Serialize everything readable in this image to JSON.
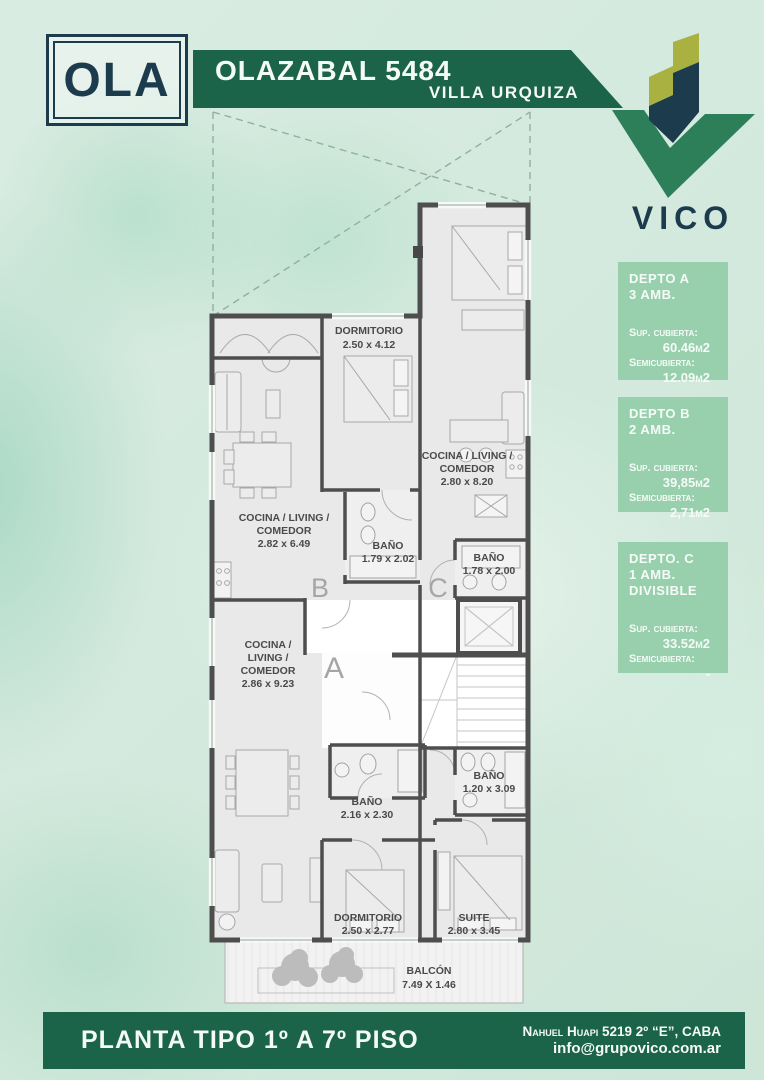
{
  "header": {
    "logo_badge": "OLA",
    "title": "OLAZABAL 5484",
    "subtitle": "VILLA URQUIZA"
  },
  "brand": {
    "wordmark": "VICO"
  },
  "units": [
    {
      "name": "DEPTO A",
      "rooms_line": "3 AMB.",
      "extra": "",
      "covered_label": "Sup. cubierta:",
      "covered": "60.46m2",
      "semi_label": "Semicubierta:",
      "semi": "12.09m2"
    },
    {
      "name": "DEPTO B",
      "rooms_line": "2 AMB.",
      "extra": "",
      "covered_label": "Sup. cubierta:",
      "covered": "39,85m2",
      "semi_label": "Semicubierta:",
      "semi": "2,71m2"
    },
    {
      "name": "DEPTO. C",
      "rooms_line": "1 AMB.",
      "extra": "DIVISIBLE",
      "covered_label": "Sup. cubierta:",
      "covered": "33.52m2",
      "semi_label": "Semicubierta:",
      "semi": "-"
    }
  ],
  "plan": {
    "unit_labels": {
      "a": "A",
      "b": "B",
      "c": "C"
    },
    "rooms": {
      "dormitorio_b": {
        "l1": "DORMITORIO",
        "l2": "2.50 x 4.12"
      },
      "living_c": {
        "l1": "COCINA / LIVING /",
        "l2": "COMEDOR",
        "l3": "2.80 x 8.20"
      },
      "living_b": {
        "l1": "COCINA / LIVING /",
        "l2": "COMEDOR",
        "l3": "2.82 x 6.49"
      },
      "bano_b": {
        "l1": "BAÑO",
        "l2": "1.79 x 2.02"
      },
      "bano_c": {
        "l1": "BAÑO",
        "l2": "1.78 x 2.00"
      },
      "living_a": {
        "l1": "COCINA /",
        "l2": "LIVING /",
        "l3": "COMEDOR",
        "l4": "2.86 x 9.23"
      },
      "bano_a": {
        "l1": "BAÑO",
        "l2": "2.16 x 2.30"
      },
      "bano_suite": {
        "l1": "BAÑO",
        "l2": "1.20 x 3.09"
      },
      "dormitorio_a": {
        "l1": "DORMITORIO",
        "l2": "2.50 x 2.77"
      },
      "suite": {
        "l1": "SUITE",
        "l2": "2.80 x 3.45"
      },
      "balcon": {
        "l1": "BALCÓN",
        "l2": "7.49 X 1.46"
      }
    }
  },
  "footer": {
    "title": "PLANTA TIPO 1º A 7º PISO",
    "address": "Nahuel Huapi 5219 2º “E”, CABA",
    "email": "info@grupovico.com.ar"
  },
  "colors": {
    "dark_green": "#1c6449",
    "card_green": "#98d0ae",
    "navy": "#1c3b4d",
    "logo_green": "#2d7f5a",
    "olive": "#a9b240"
  }
}
